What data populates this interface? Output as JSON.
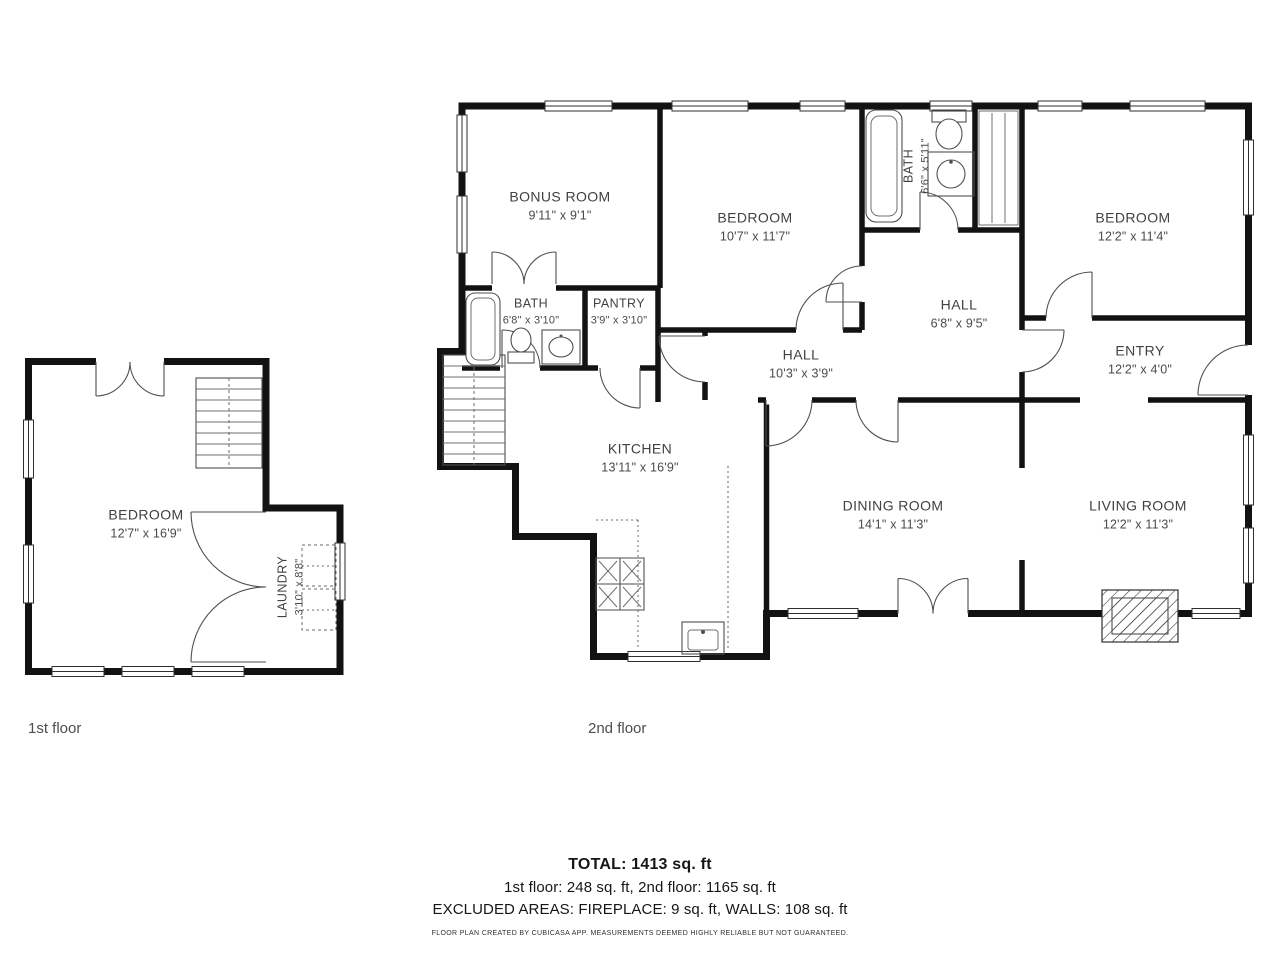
{
  "floors": [
    {
      "label": "1st floor",
      "rooms": [
        {
          "name": "BEDROOM",
          "dims": "12'7\" x 16'9\""
        },
        {
          "name": "LAUNDRY",
          "dims": "3'10\" x 8'8\""
        }
      ],
      "fixtures": [
        "stairs",
        "washer-dryer",
        "double-doors",
        "windows"
      ]
    },
    {
      "label": "2nd floor",
      "rooms": [
        {
          "name": "BONUS ROOM",
          "dims": "9'11\" x 9'1\""
        },
        {
          "name": "BEDROOM",
          "dims": "10'7\" x 11'7\""
        },
        {
          "name": "BATH",
          "dims": "6'6\" x 5'11\""
        },
        {
          "name": "BEDROOM",
          "dims": "12'2\" x 11'4\""
        },
        {
          "name": "BATH",
          "dims": "6'8\" x 3'10\""
        },
        {
          "name": "PANTRY",
          "dims": "3'9\" x 3'10\""
        },
        {
          "name": "HALL",
          "dims": "10'3\" x 3'9\""
        },
        {
          "name": "HALL",
          "dims": "6'8\" x 9'5\""
        },
        {
          "name": "ENTRY",
          "dims": "12'2\" x 4'0\""
        },
        {
          "name": "KITCHEN",
          "dims": "13'11\" x 16'9\""
        },
        {
          "name": "DINING ROOM",
          "dims": "14'1\" x 11'3\""
        },
        {
          "name": "LIVING ROOM",
          "dims": "12'2\" x 11'3\""
        }
      ],
      "fixtures": [
        "bathtub",
        "toilet",
        "sink",
        "stove",
        "kitchen-sink",
        "stairs",
        "fireplace",
        "closet-shelves"
      ]
    }
  ],
  "summary": {
    "total": "TOTAL: 1413 sq. ft",
    "floors_line": "1st floor: 248 sq. ft, 2nd floor: 1165 sq. ft",
    "excluded_line": "EXCLUDED AREAS: FIREPLACE: 9 sq. ft, WALLS: 108 sq. ft",
    "disclaimer": "FLOOR PLAN CREATED BY CUBICASA APP. MEASUREMENTS DEEMED HIGHLY RELIABLE BUT NOT GUARANTEED."
  },
  "colors": {
    "wall": "#121212",
    "thin_line": "#4f4f4f",
    "label_text": "#414141",
    "caption_text": "#4d4d4d"
  }
}
